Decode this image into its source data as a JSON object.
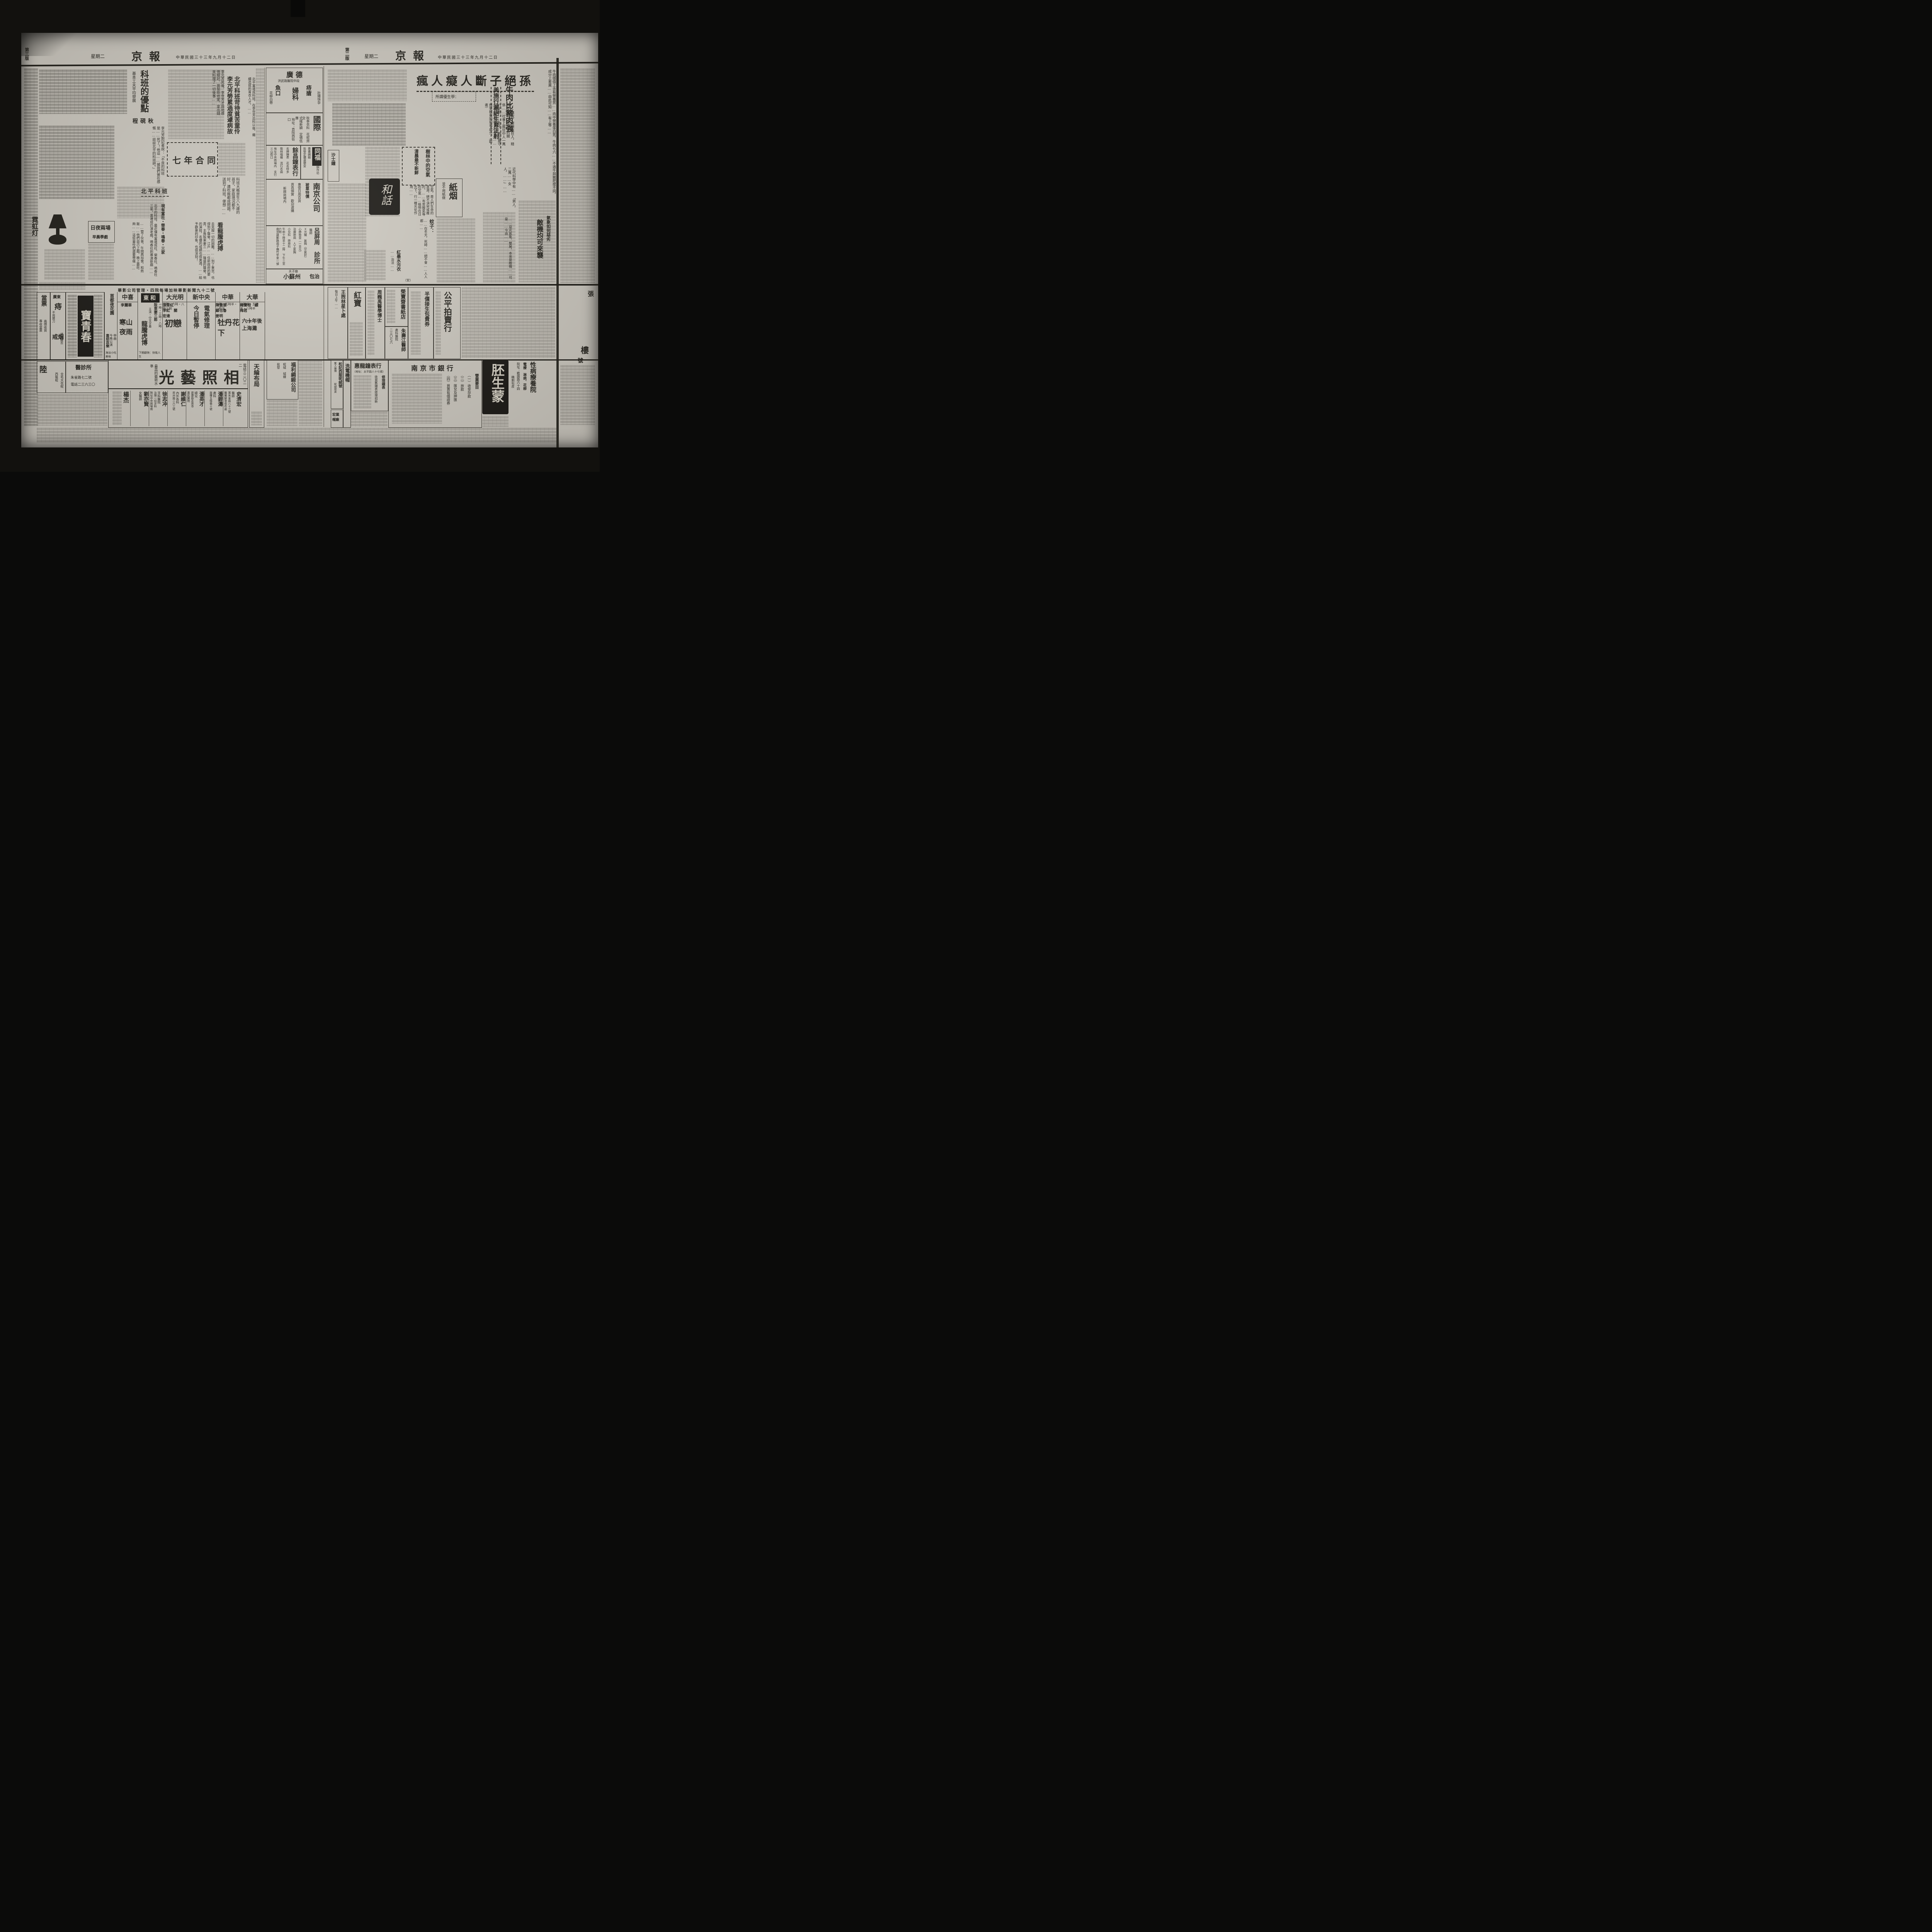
{
  "masthead": {
    "paper_name": "京報",
    "date": "中華民國三十三年九月十二日",
    "weekday": "星期二",
    "page_right": "第二版",
    "page_left": "第三版"
  },
  "left_page": {
    "youdian": {
      "headline": "科班的優點",
      "subtitle": "基本工夫平均發展",
      "subhead": "程硯秋",
      "body": "李元芳死後，李世芳才與他感情極好，曾幫助他家，拿出錢來料理了一切後事……",
      "body2": "李元芳對記者說：「不良的科班是……死了！他這……據我們實在感慨……談談北平的科班吧。」"
    },
    "keban": {
      "h1": "北平科班苛待貧苦童伶",
      "h2": "李元芳勞累過度遽病故",
      "lead": "北平富連成科班，在李世芳出科以後，繼續造就的青衣人才，……"
    },
    "qinian": {
      "title": "七年合同",
      "body": "科班大概是生八九歲的孩子，家庭境況都不好，連吃飯都成問題，送到了科班，便想……"
    },
    "beiping": {
      "title": "北平科班",
      "subtitle": "現有富社・榮春・鳴春・三家",
      "body": "北平的科班，最近僅有富連成社、榮春社、鳴春社三家。富連成仍演老戲，鳴春社則專演新戲……"
    },
    "riye": {
      "title": "日夜兩場",
      "subtitle": "早晨學戲",
      "body": "……管了伙食，午間再加食，和熱飯……他們自己上戲，晚上最吃夠……這些童伶們還要學樣……"
    },
    "longteng": {
      "title": "看龍騰虎搏",
      "body": "去克服一切的困難，……到了東京，也得到了聲譽，江戶……任新政府的要責，主角阪東妻三……隆盛的聲譽，他的演技，名優的成績也很美滿，……給予觀衆的印象，也很深刻！"
    },
    "neon": {
      "brand": "霓虹灯"
    },
    "ads": {
      "guangde": {
        "name": "廣德",
        "sub": "洪武路醫院中段",
        "i1": "痔瘡",
        "i2": "魚口",
        "i3": "婦科",
        "i4": "花柳白帶",
        "i5": "壯陽快孕"
      },
      "guoji": {
        "name": "國際",
        "l1": "秋季衣料　花呢齊全",
        "l2": "式樣新穎　定價低廉",
        "l3": "地址：貢院西街口"
      },
      "tongfu": {
        "name": "同福",
        "l1": "專賣綢緞",
        "l2": "批發定價還便宜",
        "l3": "銅作坊"
      },
      "yuchang": {
        "name": "餘昌鐘表行",
        "l1": "名牌鐘表　花名特多",
        "l2": "歌林唱機　流行名曲",
        "l3": "地址中央商場內　支行三山街口"
      },
      "nanjing": {
        "name": "南京公司",
        "l1": "被單特價",
        "l2": "專營日用百貨",
        "l3": "貨真價實　歡迎選購",
        "l4": "新興商場內"
      },
      "lv": {
        "name": "呂屏周",
        "t1": "醫師",
        "t2": "診所",
        "l1": "Ｘ光機　氣胸（空氣針）",
        "l2": "心肺檢查（一百元）",
        "l3": "治療肺病　人工氣胸",
        "l4": "小兒科　肺癆科",
        "l5": "午前十時至十二時　下午三至六時",
        "l6": "南京建鄴路鴿子橋竹竿里一號"
      },
      "suzhou": {
        "name": "小蘇州",
        "sub": "夫子廟",
        "extra": "包治"
      }
    },
    "theaters": {
      "banner": "華影公司管理・四院每場加映華影新聞九十二號",
      "halls": [
        {
          "name": "大華",
          "times": "二時半・五時半・八時半",
          "cast": "韓蘭根　顧梅君",
          "note": "主演",
          "film": "六十年後上海灘",
          "next": ""
        },
        {
          "name": "中華",
          "times": "二時・五時半・八時半",
          "cast": "陳雲裳　顧也魯　姜明",
          "note": "主演",
          "film": "牡丹花下",
          "next": ""
        },
        {
          "name": "新中央",
          "times": "",
          "cast": "電氣修理",
          "note": "",
          "film": "今日暫停",
          "next": ""
        },
        {
          "name": "大光明",
          "times": "三時・六時・八時三刻",
          "cast": "張翠紅　李紅　關宏達",
          "note": "主演",
          "film": "初戀",
          "next": ""
        },
        {
          "name": "東和",
          "times": "一時・三時・八時",
          "cast": "阪東妻三郎",
          "note": "主演・中文字幕",
          "film": "龍騰虎博",
          "next": "下期獻映：快哉人生"
        },
        {
          "name": "中喜",
          "times": "",
          "cast": "李麗華",
          "note": "主演",
          "film": "寒山夜雨",
          "next": ""
        },
        {
          "name": "首都夜花園",
          "times": "今晚公演",
          "cast": "申曲",
          "note": "",
          "film": "喜怒哀樂",
          "next": "海派小吃美味"
        }
      ]
    },
    "bottom": {
      "guangyi": {
        "name": "光藝照相",
        "side": "最高的藝術水準",
        "phone": "電話三二〇二二"
      },
      "doctors": [
        {
          "name": "史濟宏",
          "title": "醫師",
          "l1": "寓朱雀路八十三號",
          "l2": "醫藥解答收件處"
        },
        {
          "name": "潘碧濤",
          "title": "產科",
          "l1": "鼓樓五條巷十號",
          "l2": ""
        },
        {
          "name": "潘英才",
          "title": "婦兒",
          "l1": "建康路永恩寺",
          "l2": "惠民醫院"
        },
        {
          "name": "謝維仁",
          "title": "內外各科",
          "l1": "昇州路二六三號",
          "l2": ""
        },
        {
          "name": "徐志冲",
          "title": "牙科醫院",
          "l1": "治理一切牙科",
          "l2": "院址中央商場南"
        },
        {
          "name": "劉亦賢",
          "title": "女醫師",
          "l1": "",
          "l2": ""
        },
        {
          "name": "楊杰",
          "title": "",
          "l1": "",
          "l2": ""
        }
      ],
      "tianlun": {
        "name": "天綸布局"
      },
      "fuli": {
        "name": "福利綢緞公司",
        "l1": "呢絨　絨線",
        "l2": "批發"
      },
      "baoqingchun": {
        "name": "寶青春"
      },
      "guangdong": {
        "name": "廣東",
        "big1": "痔",
        "big2": "戒烟",
        "l1": "不用開刀",
        "l2": "絕無痛苦"
      },
      "dangpiao": {
        "name": "當票",
        "l1": "高價收買",
        "l2": "專收當票"
      },
      "lu": {
        "name": "陸",
        "l1": "全毛大衣呢",
        "l2": "西裝呢"
      },
      "zhensuo": {
        "name": "醫診所",
        "l1": "朱雀路七二號",
        "l2": "電話二三六三〇"
      }
    }
  },
  "right_page": {
    "fengren": {
      "headline": "瘋人癡人斷子絕孫",
      "kicker": "所謂優生學：",
      "body": "……講說，癡癲瘋狂人，精神不健全，能遺傳的關係……社會上瘋狂中人一萬六千是……此中，倘在嚴守祕密，倘有非法行使之……應受極重的刑事處分。（歐者）"
    },
    "meishi": {
      "headline": "美施行滅絕生育注射",
      "body": "近代科學中有……「男人，二萬……女人，……」……"
    },
    "niurou": {
      "headline": "牛肉比豬肉強",
      "body": "牛肉價值上含有營養質……肉中營養蛋白質，牛肉七六……不過牛與豬肥瘦不同，成分上差異……由此可知……有上等……"
    },
    "shulin": {
      "t1": "樹林中的空氣",
      "t2": "清晨最不新鮮",
      "body": "空氣，是人們生命的泉源，絕不須臾或離的。……有炭酸氣等的空氣……植物在日光下，行一種光化作用……"
    },
    "zhiyan": {
      "title": "紙烟",
      "sub": "並不用紙做"
    },
    "hehua": {
      "label": "和話"
    },
    "shashi": {
      "label": "沙士鐘"
    },
    "wenzi": {
      "head": "蚊子：",
      "body": "……在冬天，死時……絕不會……人人都……",
      "sig": "（安）"
    },
    "hongmo": {
      "head": "紅墨水污衣",
      "body": "……治法……"
    },
    "qixiang": {
      "h1": "氣象如何惡劣",
      "h2": "敵機均可來襲",
      "body": "……惡劣氣象，雙層，本來是敵機……可是……今由……"
    },
    "band1": {
      "gongping": {
        "name": "公平拍賣行"
      },
      "jiesheng": {
        "name": "半價接生包費券"
      },
      "rongbao": {
        "name": "榮寶齋書紙店"
      },
      "zhu": {
        "name": "朱壽江醫師",
        "l1": "產科醫院",
        "l2": "二三〇七六"
      },
      "zhou": {
        "name": "周巍禹醫學博士"
      },
      "hongbao": {
        "name": "紅寶"
      },
      "wang": {
        "name": "王煦林星卜處",
        "l1": "每日上午……"
      }
    },
    "band2": {
      "huilong": {
        "name": "惠龍鐘表行",
        "sub": "（地址：太平路八十七號）",
        "l1": "修理鐘表",
        "l2": "收買舊鐘表修理如新"
      },
      "ximao": {
        "name": "洗電機帽"
      },
      "songji": {
        "name": "松記西服呢絨號",
        "l1": "驚人廉價",
        "l2": "呢絨現貨",
        "l3": "歡迎參觀"
      },
      "hongye": {
        "name": "宏業帽廠"
      },
      "bank": {
        "name": "南京市銀行",
        "sub": "營業要目",
        "i1": "（一）收受存款",
        "i2": "（二）放款",
        "i3": "（三）匯兌及押匯",
        "i4": "（四）買賣有價證券"
      },
      "peisheng": {
        "name": "胚生蒙"
      },
      "xingbing": {
        "name": "性病療養院",
        "l1": "電療　淋病、花柳",
        "l2": "院址：瞻園路六十四",
        "l3": "精割包皮"
      }
    },
    "edge": {
      "c1": "張",
      "c2": "樓",
      "c3": "號"
    }
  }
}
